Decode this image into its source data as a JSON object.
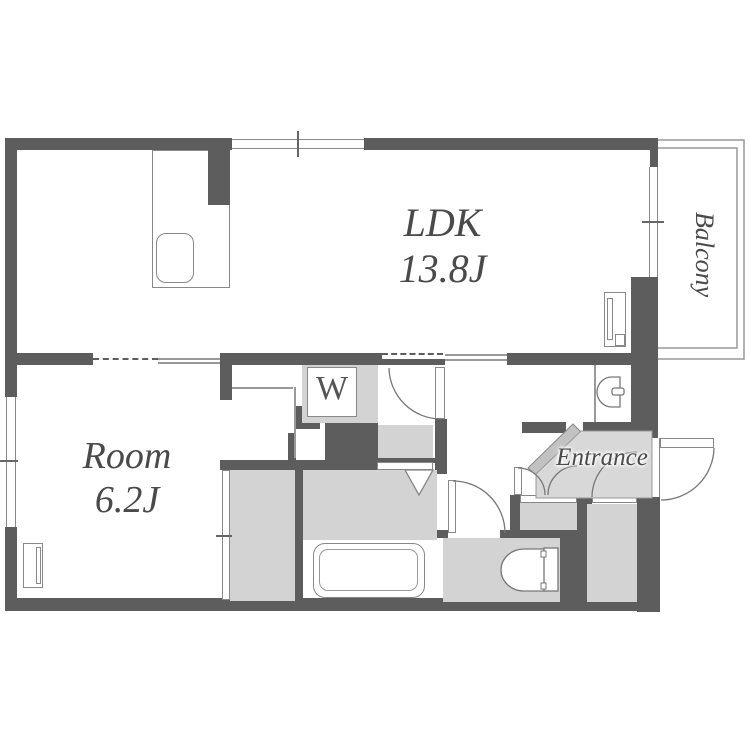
{
  "plan_title": "apartment-floor-plan",
  "labels": {
    "ldk_name": "LDK",
    "ldk_size": "13.8J",
    "room_name": "Room",
    "room_size": "6.2J",
    "balcony": "Balcony",
    "entrance": "Entrance",
    "washer": "W"
  },
  "colors": {
    "wall": "#5d5d5d",
    "floor": "#d3d3d3",
    "step": "#c2c2c2",
    "line": "#888888",
    "thin": "#999999",
    "text": "#4a4a4a"
  },
  "fixtures": [
    "kitchen-sink",
    "washing-machine",
    "bathtub",
    "toilet",
    "washbasin",
    "closet",
    "shoe-cabinet",
    "storage-room",
    "front-door",
    "balcony-rail"
  ]
}
